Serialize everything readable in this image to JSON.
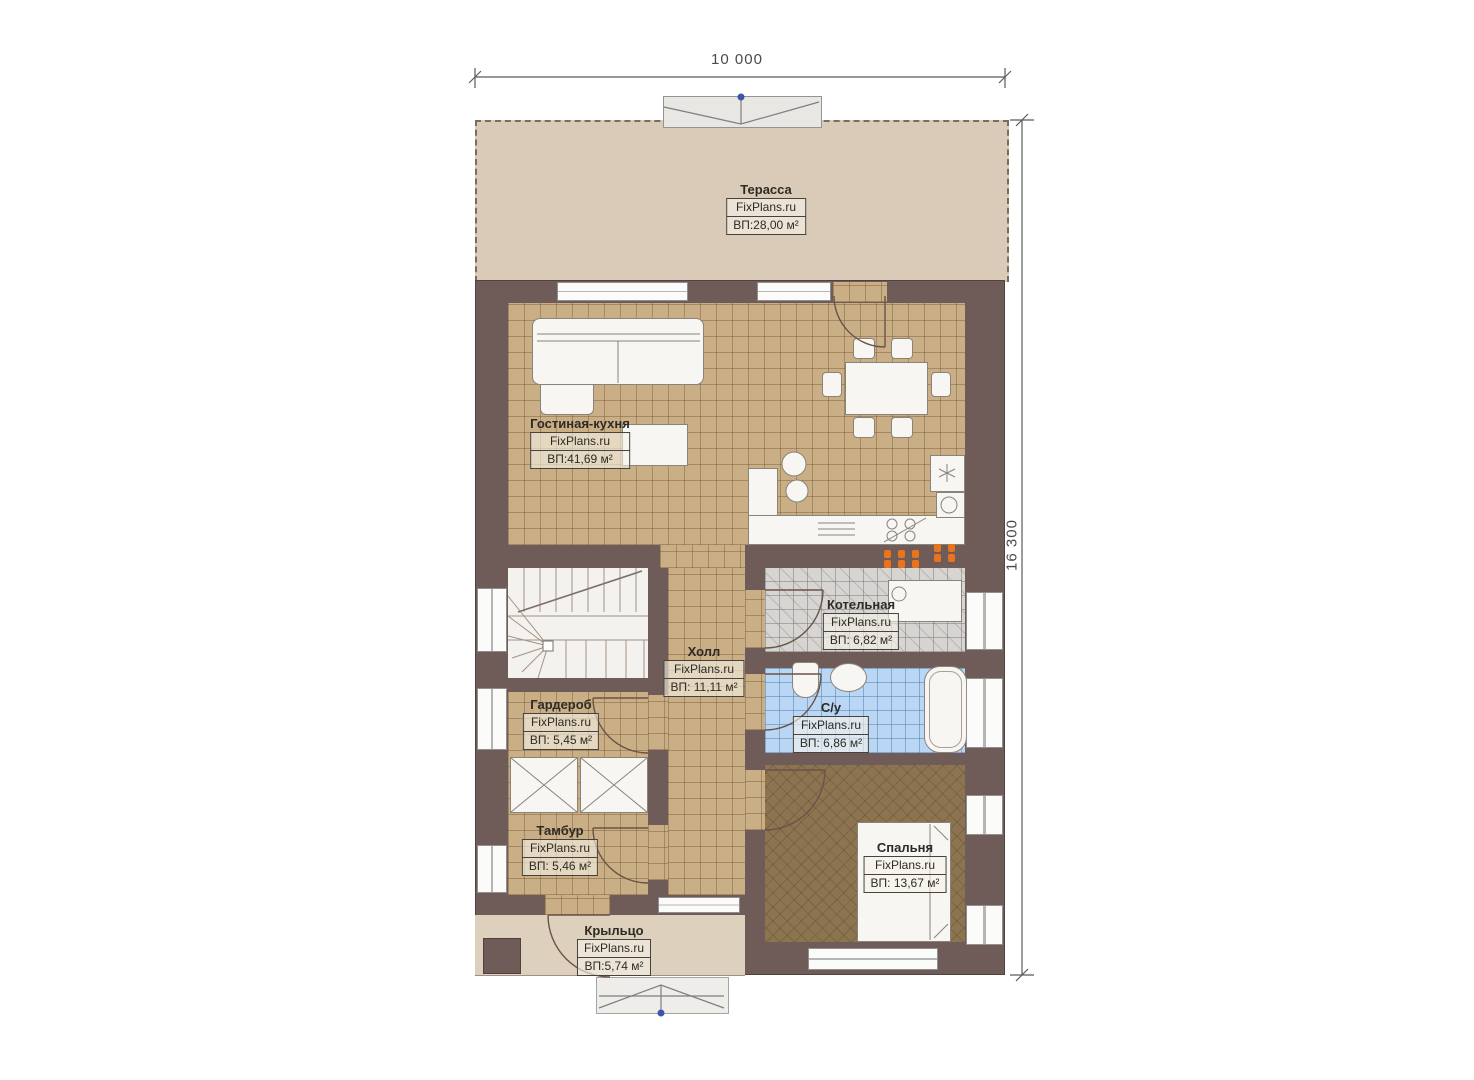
{
  "plan": {
    "brand": "FixPlans.ru",
    "dimensions": {
      "width_label": "10 000",
      "height_label": "16 300"
    },
    "rooms": [
      {
        "id": "terrace",
        "name": "Терасса",
        "brand": "FixPlans.ru",
        "area": "ВП:28,00 м²"
      },
      {
        "id": "living",
        "name": "Гостиная-кухня",
        "brand": "FixPlans.ru",
        "area": "ВП:41,69 м²"
      },
      {
        "id": "boiler",
        "name": "Котельная",
        "brand": "FixPlans.ru",
        "area": "ВП: 6,82 м²"
      },
      {
        "id": "hall",
        "name": "Холл",
        "brand": "FixPlans.ru",
        "area": "ВП: 11,11 м²"
      },
      {
        "id": "wardrobe",
        "name": "Гардероб",
        "brand": "FixPlans.ru",
        "area": "ВП: 5,45 м²"
      },
      {
        "id": "bathroom",
        "name": "С/у",
        "brand": "FixPlans.ru",
        "area": "ВП: 6,86 м²"
      },
      {
        "id": "tambour",
        "name": "Тамбур",
        "brand": "FixPlans.ru",
        "area": "ВП: 5,46 м²"
      },
      {
        "id": "bedroom",
        "name": "Спальня",
        "brand": "FixPlans.ru",
        "area": "ВП: 13,67 м²"
      },
      {
        "id": "porch",
        "name": "Крыльцо",
        "brand": "FixPlans.ru",
        "area": "ВП:5,74 м²"
      }
    ],
    "colors": {
      "wall": "#6f5c59",
      "floor_tile_tan": "#c9ae86",
      "floor_tile_grey": "#d7d5d2",
      "floor_tile_blue": "#b9d7f5",
      "floor_carpet": "#8c7450",
      "terrace_beige": "#d9cbb7",
      "accent_orange": "#e8751c",
      "accent_blue_dot": "#3d55a8"
    }
  }
}
